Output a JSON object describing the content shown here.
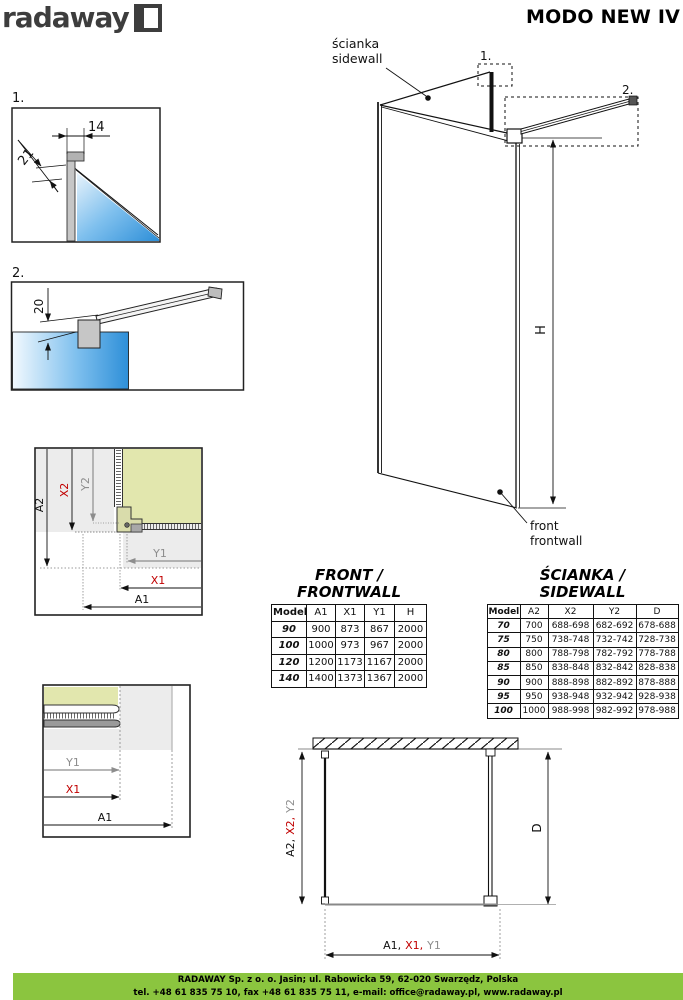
{
  "header": {
    "logo_text": "radaway",
    "title": "MODO NEW IV"
  },
  "diagrams": {
    "detail1": {
      "num": "1.",
      "dim_width": "14",
      "dim_depth": "21"
    },
    "detail2": {
      "num": "2.",
      "dim_height": "20"
    },
    "iso": {
      "callout1": "1.",
      "callout2": "2.",
      "sidewall_label_line1": "ścianka",
      "sidewall_label_line2": "sidewall",
      "frontwall_label_line1": "front",
      "frontwall_label_line2": "frontwall",
      "height": "H"
    },
    "plan_corner": {
      "a2": "A2",
      "x2": "X2",
      "y2": "Y2",
      "y1": "Y1",
      "x1": "X1",
      "a1": "A1"
    },
    "plan_edge": {
      "y1": "Y1",
      "x1": "X1",
      "a1": "A1"
    },
    "plan_overall": {
      "left_a2": "A2,",
      "left_x2": "X2,",
      "left_y2": "Y2",
      "d": "D",
      "bottom_a1": "A1,",
      "bottom_x1": "X1,",
      "bottom_y1": "Y1"
    }
  },
  "tables": {
    "front": {
      "title_line1": "FRONT /",
      "title_line2": "FRONTWALL",
      "headers": [
        "Model",
        "A1",
        "X1",
        "Y1",
        "H"
      ],
      "rows": [
        [
          "90",
          "900",
          "873",
          "867",
          "2000"
        ],
        [
          "100",
          "1000",
          "973",
          "967",
          "2000"
        ],
        [
          "120",
          "1200",
          "1173",
          "1167",
          "2000"
        ],
        [
          "140",
          "1400",
          "1373",
          "1367",
          "2000"
        ]
      ]
    },
    "side": {
      "title_line1": "ŚCIANKA /",
      "title_line2": "SIDEWALL",
      "headers": [
        "Model",
        "A2",
        "X2",
        "Y2",
        "D"
      ],
      "rows": [
        [
          "70",
          "700",
          "688-698",
          "682-692",
          "678-688"
        ],
        [
          "75",
          "750",
          "738-748",
          "732-742",
          "728-738"
        ],
        [
          "80",
          "800",
          "788-798",
          "782-792",
          "778-788"
        ],
        [
          "85",
          "850",
          "838-848",
          "832-842",
          "828-838"
        ],
        [
          "90",
          "900",
          "888-898",
          "882-892",
          "878-888"
        ],
        [
          "95",
          "950",
          "938-948",
          "932-942",
          "928-938"
        ],
        [
          "100",
          "1000",
          "988-998",
          "982-992",
          "978-988"
        ]
      ]
    }
  },
  "footer": {
    "line1": "RADAWAY Sp. z o. o. Jasin; ul. Rabowicka 59, 62-020 Swarzędz, Polska",
    "line2": "tel. +48 61 835 75 10, fax +48 61 835 75 11, e-mail: office@radaway.pl, www.radaway.pl"
  },
  "colors": {
    "accent_red": "#c10000",
    "accent_gray": "#8d8d8d",
    "interior_green": "#e2e7ae",
    "footer_green": "#8bc53f",
    "glass_blue": "#2e8fd8"
  }
}
